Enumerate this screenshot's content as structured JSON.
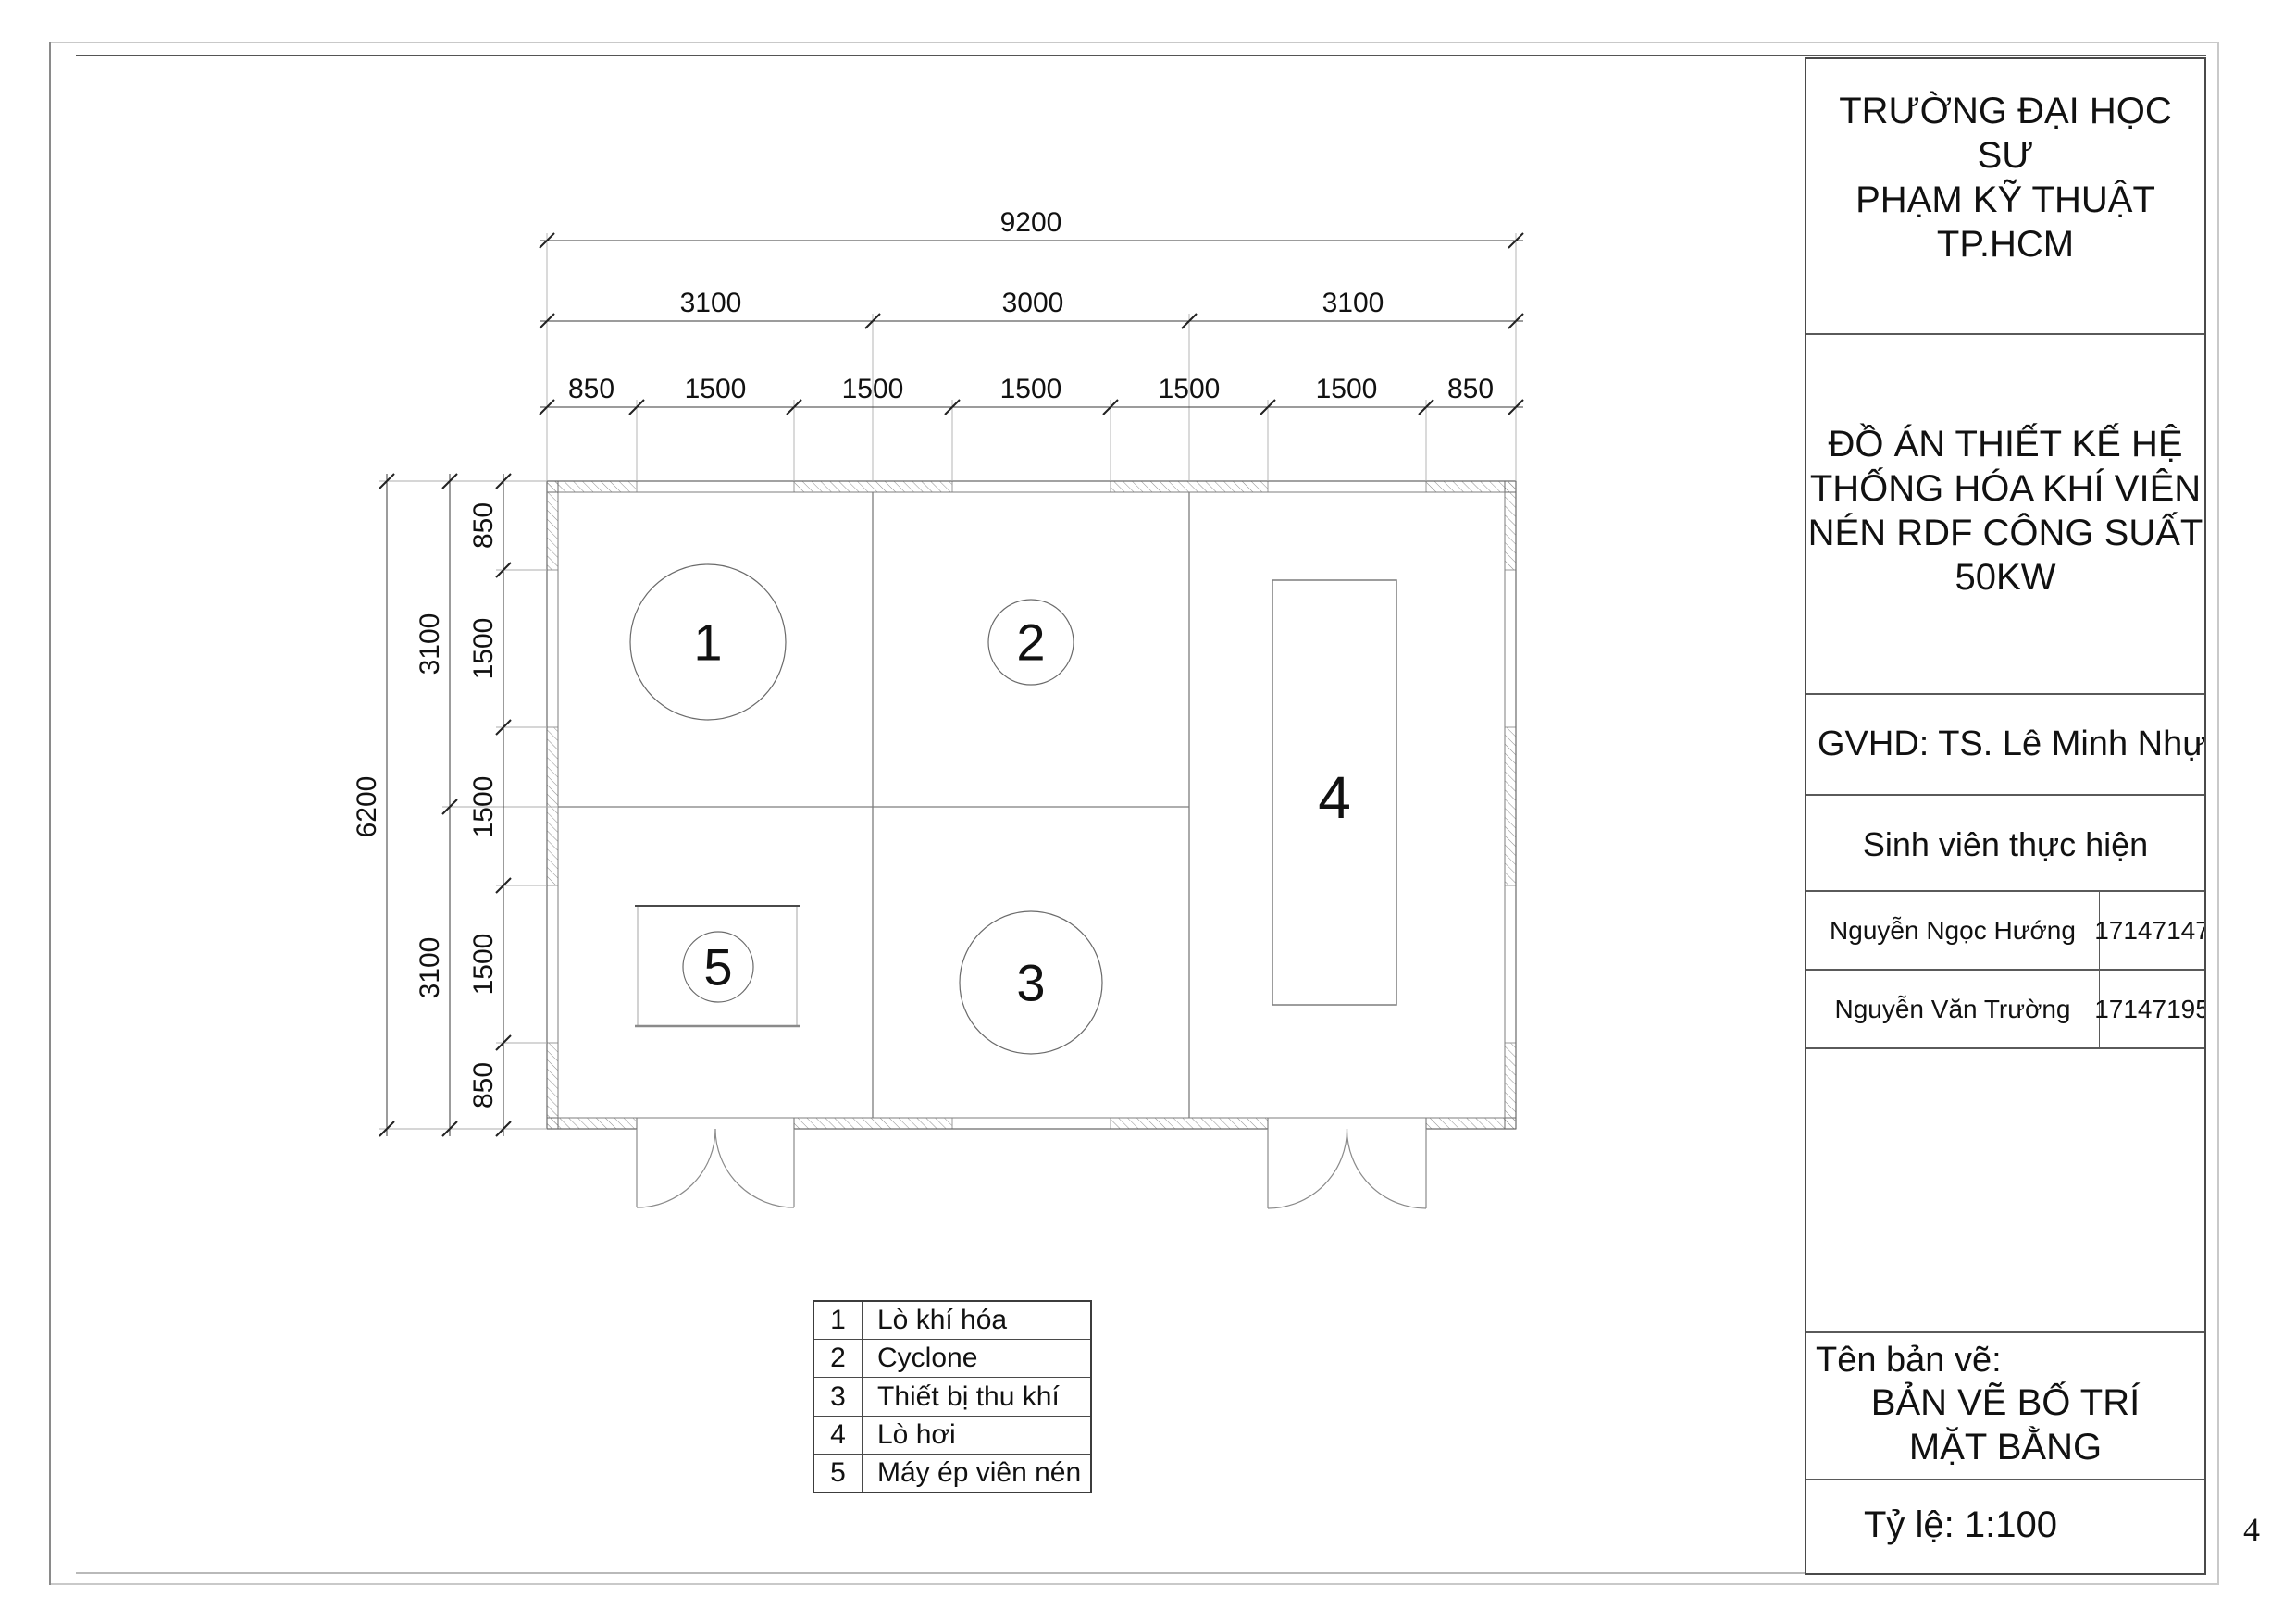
{
  "title_block": {
    "university_lines": [
      "TRƯỜNG ĐẠI HỌC SƯ",
      "PHẠM KỸ THUẬT",
      "TP.HCM"
    ],
    "project_lines": [
      "ĐỒ ÁN THIẾT KẾ HỆ",
      "THỐNG HÓA KHÍ VIÊN",
      "NÉN RDF CÔNG SUẤT",
      "50KW"
    ],
    "advisor": "GVHD: TS. Lê Minh Nhựt",
    "students_header": "Sinh viên thực hiện",
    "students": [
      {
        "name": "Nguyễn Ngọc Hướng",
        "id": "17147147"
      },
      {
        "name": "Nguyễn Văn Trường",
        "id": "17147195"
      }
    ],
    "drawing_name_label": "Tên bản vẽ:",
    "drawing_name_lines": [
      "BẢN VẼ BỐ TRÍ",
      "MẶT BẰNG"
    ],
    "scale": "Tỷ lệ: 1:100"
  },
  "page_number": "4",
  "legend": {
    "rows": [
      {
        "no": "1",
        "label": "Lò khí hóa"
      },
      {
        "no": "2",
        "label": "Cyclone"
      },
      {
        "no": "3",
        "label": "Thiết bị thu khí"
      },
      {
        "no": "4",
        "label": "Lò hơi"
      },
      {
        "no": "5",
        "label": "Máy ép viên nén"
      }
    ]
  },
  "plan": {
    "equipment_labels": {
      "gasifier": "1",
      "cyclone": "2",
      "gas_collector": "3",
      "boiler": "4",
      "pellet_press": "5"
    },
    "dims": {
      "total_width": "9200",
      "width_spans": [
        "3100",
        "3000",
        "3100"
      ],
      "width_segments": [
        "850",
        "1500",
        "1500",
        "1500",
        "1500",
        "1500",
        "850"
      ],
      "total_height": "6200",
      "height_spans": [
        "3100",
        "3100"
      ],
      "height_segments": [
        "850",
        "1500",
        "1500",
        "1500",
        "850"
      ]
    }
  }
}
